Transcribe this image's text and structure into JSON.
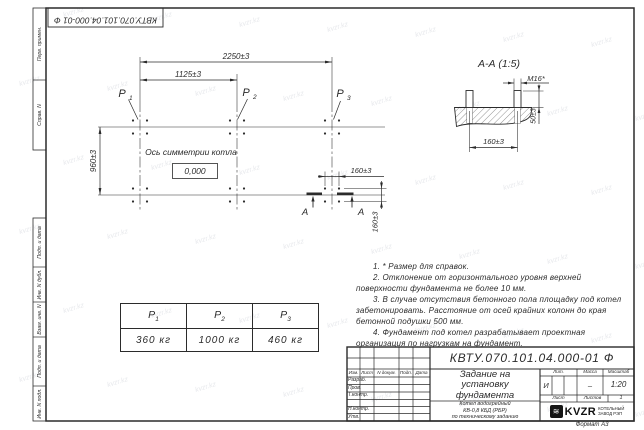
{
  "frame": {
    "doc_number_top": "КВТУ.070.101.04.000-01 Ф",
    "strip_top": [
      "Перв. примен.",
      "Справ. N"
    ],
    "strip_bottom": [
      "Подп. и дата",
      "Инв. N дубл.",
      "Взам. инв. N",
      "Подп. и дата",
      "Инв. N подл."
    ],
    "format_label": "Формат А3"
  },
  "plan": {
    "p_labels": [
      {
        "base": "P",
        "sub": "1"
      },
      {
        "base": "P",
        "sub": "2"
      },
      {
        "base": "P",
        "sub": "3"
      }
    ],
    "dim_overall": "2250±3",
    "dim_half": "1125±3",
    "dim_depth": "960±3",
    "dim_bolt_x": "160±3",
    "dim_bolt_y": "160±3",
    "axis_label": "Ось симметрии котла",
    "elevation_mark": "0,000",
    "section_letters": [
      "А",
      "А"
    ]
  },
  "section_view": {
    "title": "А-А (1:5)",
    "dim_thread": "М16*",
    "dim_protrusion": "50±3",
    "dim_spacing": "160±3"
  },
  "loads_table": {
    "headers": [
      {
        "base": "P",
        "sub": "1"
      },
      {
        "base": "P",
        "sub": "2"
      },
      {
        "base": "P",
        "sub": "3"
      }
    ],
    "values": [
      "360  кг",
      "1000  кг",
      "460  кг"
    ]
  },
  "notes": [
    "1. * Размер для справок.",
    "2. Отклонение от горизонтального уровня верхней поверхности фундамента не более 10 мм.",
    "3. В случае отсутствия бетонного пола площадку под котел забетонировать. Расстояние от осей крайних колонн до края бетонной подушки 500 мм.",
    "4. Фундамент под котел разрабатывает проектная организация по нагрузкам на фундамент."
  ],
  "title_block": {
    "doc_number": "КВТУ.070.101.04.000-01 Ф",
    "title_lines": [
      "Задание на",
      "установку",
      "фундамента"
    ],
    "subtitle_lines": [
      "Котел водогрейный",
      "КВ-0,8 КБД (РБР)",
      "по техническому заданию"
    ],
    "header_cells": [
      "Изм.",
      "Лист",
      "N докум.",
      "Подп.",
      "Дата"
    ],
    "sign_rows": [
      "Разраб.",
      "Пров.",
      "Т.контр.",
      "",
      "Н.контр.",
      "Утв."
    ],
    "lit_label": "Лит.",
    "lit_value": "И",
    "mass_label": "Масса",
    "mass_value": "–",
    "scale_label": "Масштаб",
    "scale_value": "1:20",
    "sheet_label": "Лист",
    "sheets_label": "Листов",
    "sheets_value": "1",
    "company": {
      "logo": "KVZR",
      "glyph": "≋",
      "name_lines": [
        "КОТЕЛЬНЫЙ",
        "ЗАВОД РЭП"
      ]
    }
  },
  "watermark": "kvzr.kz",
  "colors": {
    "line": "#2b2b2b",
    "paper": "#ffffff",
    "watermark": "#c9ccd4"
  }
}
